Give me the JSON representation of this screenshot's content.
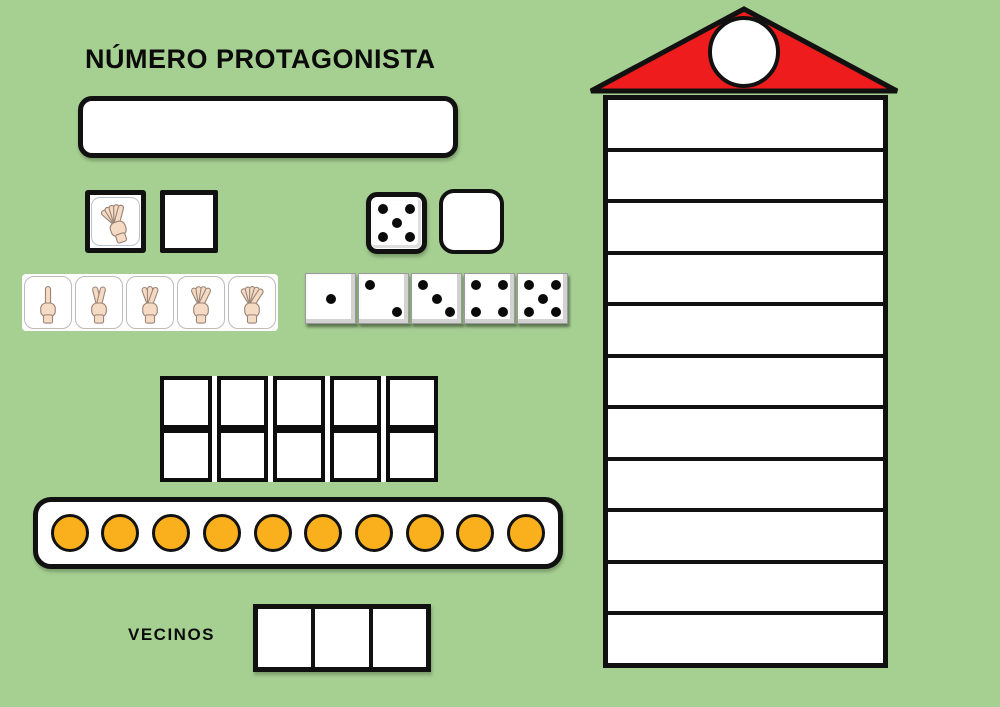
{
  "title": "NÚMERO PROTAGONISTA",
  "vecinos_label": "VECINOS",
  "colors": {
    "background": "#a6cf92",
    "border_black": "#111111",
    "roof_red": "#ee1c1c",
    "counter_orange": "#f9b01c",
    "hand_skin": "#f5dac4"
  },
  "protagonist_box": {
    "value": ""
  },
  "hand_prompt": {
    "fingers_shown": 5,
    "answer_value": ""
  },
  "dice_prompt": {
    "pips_shown": 5,
    "answer_value": ""
  },
  "hand_cards": {
    "finger_counts": [
      1,
      2,
      3,
      4,
      5
    ]
  },
  "dice_cards": {
    "pip_counts": [
      1,
      2,
      3,
      4,
      5
    ]
  },
  "ten_frame": {
    "rows": 2,
    "cols": 5,
    "filled": 0
  },
  "counter_strip": {
    "count": 10
  },
  "vecinos_row": {
    "cells": 3,
    "values": [
      "",
      "",
      ""
    ]
  },
  "building": {
    "floors": 11,
    "roof_circle_value": ""
  }
}
